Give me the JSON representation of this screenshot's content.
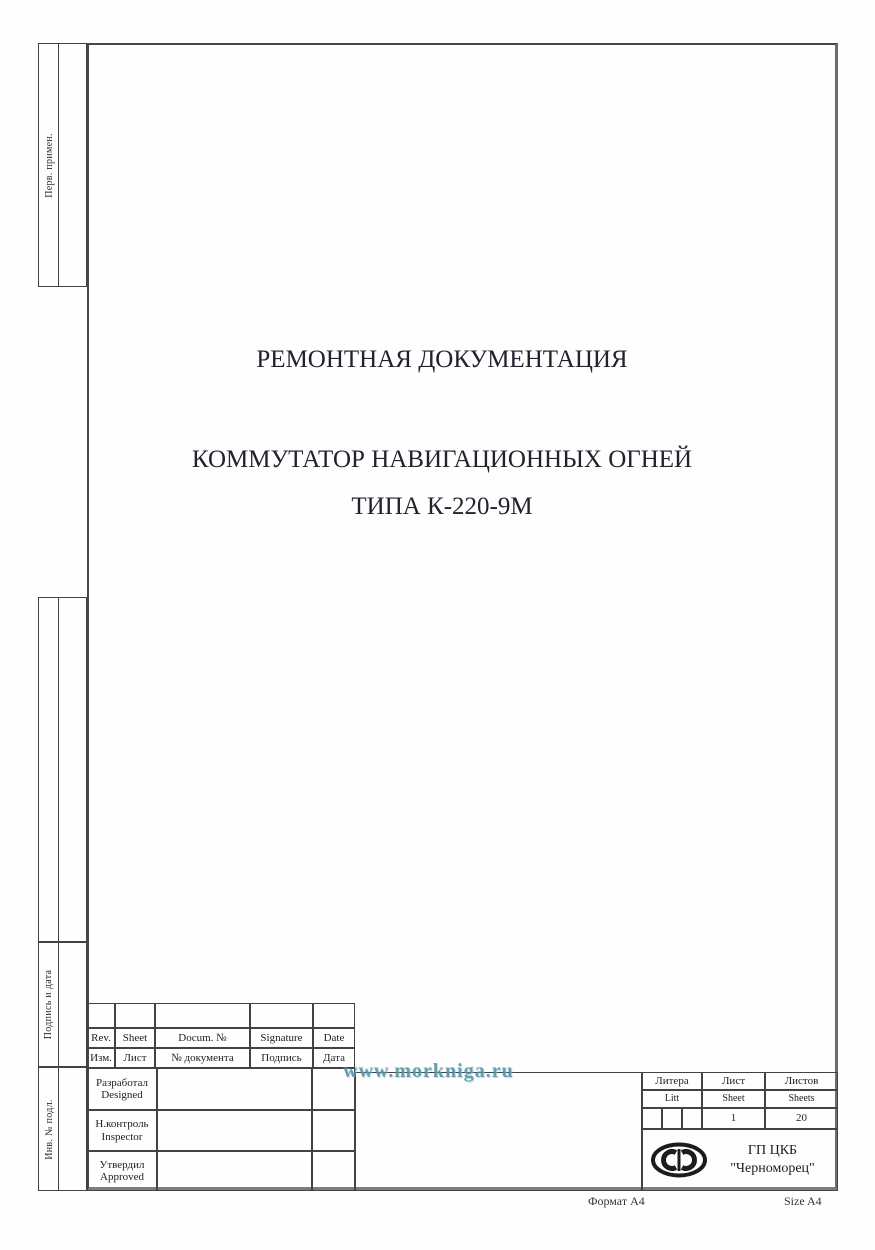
{
  "page": {
    "watermark": "www.morkniga.ru",
    "format_note_left": "Формат А4",
    "format_note_right": "Size A4"
  },
  "colors": {
    "watermark_teal": "#4a8c9e",
    "frame_line": "#424242"
  },
  "sidebar": {
    "boxes": [
      {
        "label": "Перв. примен."
      },
      {
        "label": ""
      },
      {
        "label": "Подпись и дата"
      },
      {
        "label": "Инв. № подл."
      }
    ]
  },
  "title": {
    "line1": "РЕМОНТНАЯ ДОКУМЕНТАЦИЯ",
    "line2": "КОММУТАТОР НАВИГАЦИОННЫХ ОГНЕЙ",
    "line3": "ТИПА К-220-9М"
  },
  "title_block": {
    "revision_header_en": [
      "Rev.",
      "Sheet",
      "Docum. №",
      "Signature",
      "Date"
    ],
    "revision_header_ru": [
      "Изм.",
      "Лист",
      "№ документа",
      "Подпись",
      "Дата"
    ],
    "roles": [
      {
        "ru": "Разработал",
        "en": "Designed"
      },
      {
        "ru": "Н.контроль",
        "en": "Inspector"
      },
      {
        "ru": "Утвердил",
        "en": "Approved"
      }
    ],
    "litera": {
      "ru": "Литера",
      "en": "Litt"
    },
    "list": {
      "ru": "Лист",
      "en": "Sheet",
      "value": "1"
    },
    "listov": {
      "ru": "Листов",
      "en": "Sheets",
      "value": "20"
    },
    "company": {
      "line1": "ГП ЦКБ",
      "line2": "\"Черноморец\""
    },
    "logo_name": "chernomorets-logo"
  }
}
